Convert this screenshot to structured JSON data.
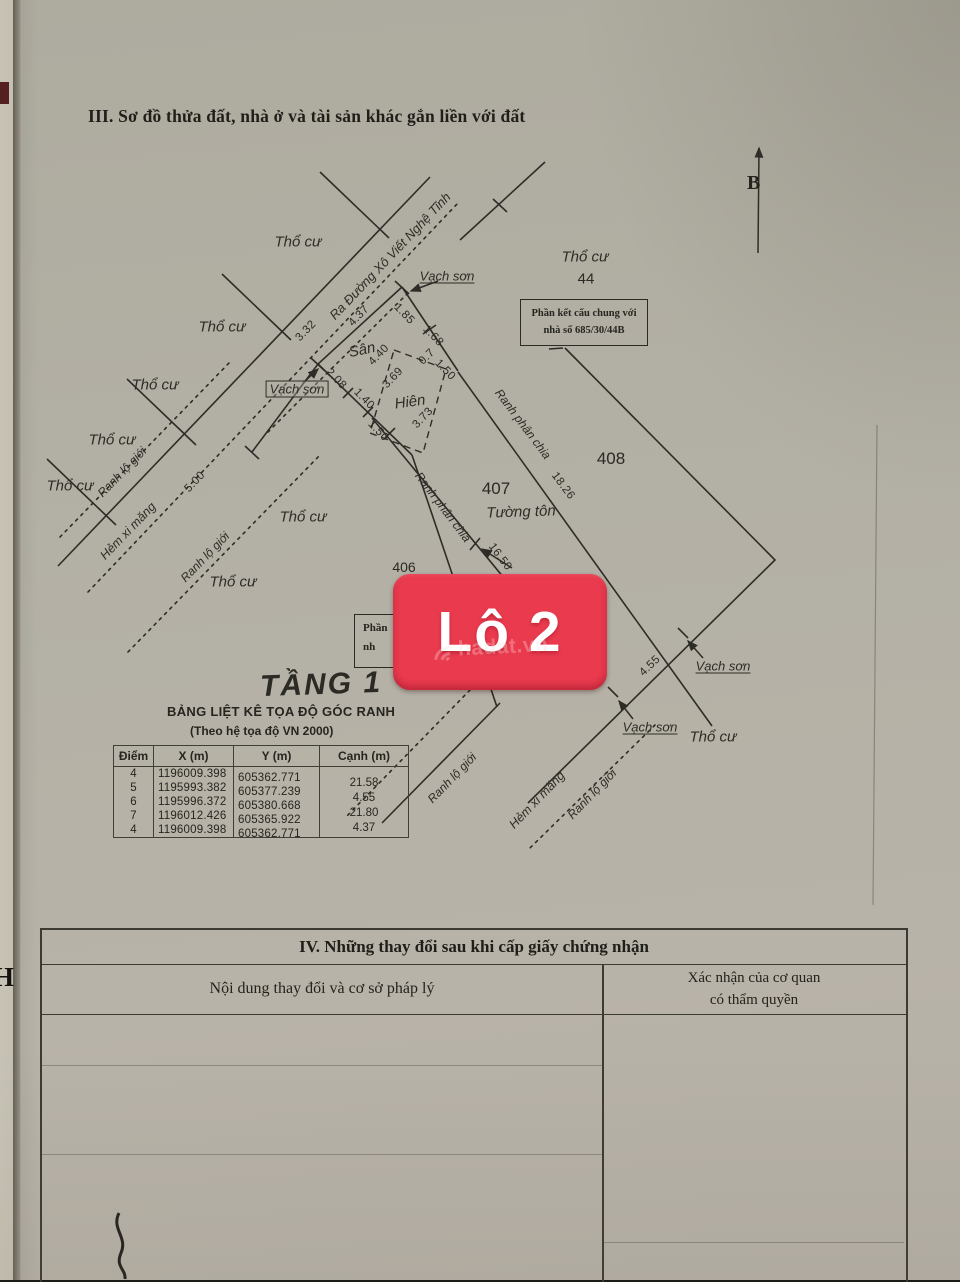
{
  "colors": {
    "badge_red": "#e93a4e",
    "paper": "#b2afa4",
    "ink": "#2e2c27"
  },
  "header": {
    "section3_title": "III. Sơ đồ thửa đất, nhà ở và tài sản khác gắn liền với đất"
  },
  "compass": {
    "north_label": "B"
  },
  "edge": {
    "stray_letter": "H"
  },
  "badge": {
    "label": "Lô 2",
    "watermark": "hadat.vn"
  },
  "diagram": {
    "road_label": "Ra Đường Xô Viết Nghệ Tĩnh",
    "floor_label": "TẦNG 1",
    "labels": {
      "tho_cu": "Thổ cư",
      "vach_son": "Vạch sơn",
      "ranh_lo_gioi": "Ranh lộ giới",
      "hem_xi_mang": "Hẻm xi măng",
      "ranh_phan_chia": "Ranh phân chia",
      "san": "Sân",
      "hien": "Hiên",
      "tuong_ton": "Tường tôn"
    },
    "plots": {
      "subject": "406",
      "neighbor_right": "407",
      "neighbor_far": "408",
      "neighbor_top": "44"
    },
    "note": {
      "line1": "Phần kết cấu chung với",
      "line2": "nhà số 685/30/44B"
    },
    "partial_note": {
      "line1": "Phần",
      "line2": "nh"
    },
    "dims": {
      "front_1": "3.32",
      "front_2": "4.37",
      "side_r1": "1.85",
      "side_r2": "1.68",
      "san_width": "4.40",
      "side_l1": "2.08",
      "side_l2": "1.40",
      "side_l3": "1.50",
      "hien_a": "3.69",
      "hien_b": "3.73",
      "hien_c": "0.7",
      "hien_d": "1.50",
      "alley_width": "5.00",
      "rear": "16.50",
      "divider": "18.26",
      "bottom": "4.55"
    }
  },
  "coord_table": {
    "title": "BẢNG LIỆT KÊ TỌA ĐỘ GÓC RANH",
    "subtitle": "(Theo hệ tọa độ VN 2000)",
    "headers": [
      "Điểm",
      "X (m)",
      "Y (m)",
      "Cạnh (m)"
    ],
    "rows": [
      [
        "4",
        "1196009.398",
        "605362.771"
      ],
      [
        "5",
        "1195993.382",
        "605377.239"
      ],
      [
        "6",
        "1195996.372",
        "605380.668"
      ],
      [
        "7",
        "1196012.426",
        "605365.922"
      ],
      [
        "4",
        "1196009.398",
        "605362.771"
      ]
    ],
    "edges": [
      "21.58",
      "4.55",
      "21.80",
      "4.37"
    ]
  },
  "section4": {
    "title": "IV. Những thay đổi sau khi cấp giấy chứng nhận",
    "col1_header": "Nội dung thay đổi và cơ sở pháp lý",
    "col2_line1": "Xác nhận của cơ quan",
    "col2_line2": "có thẩm quyền"
  }
}
